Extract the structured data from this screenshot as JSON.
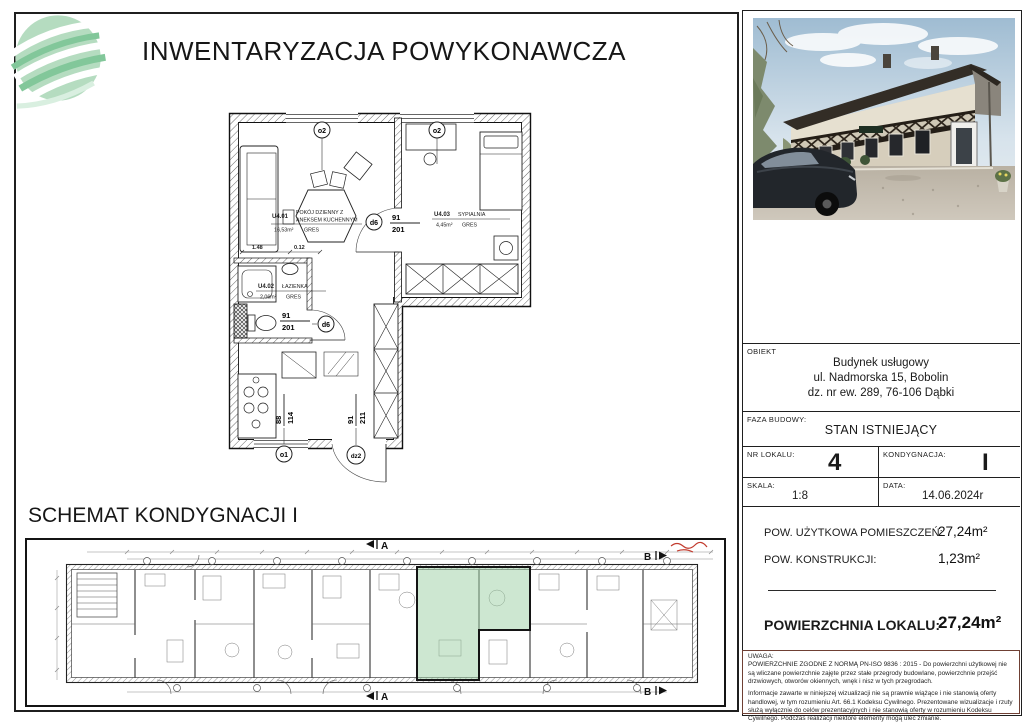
{
  "header": {
    "title": "INWENTARYZACJA POWYKONAWCZA"
  },
  "floor_plan": {
    "rooms": [
      {
        "id": "U4.01",
        "name_line1": "POKÓJ DZIENNY Z",
        "name_line2": "ANEKSEM KUCHENNYM",
        "area": "16,53m²",
        "floor": "GRES"
      },
      {
        "id": "U4.03",
        "name_line1": "SYPIALNIA",
        "name_line2": "",
        "area": "4,45m²",
        "floor": "GRES"
      },
      {
        "id": "U4.02",
        "name_line1": "ŁAZIENKA",
        "name_line2": "",
        "area": "2,06m²",
        "floor": "GRES"
      }
    ],
    "openings": [
      {
        "symbol": "o2",
        "dim_top": "",
        "dim_bottom": ""
      },
      {
        "symbol": "o2",
        "dim_top": "",
        "dim_bottom": ""
      },
      {
        "symbol": "d6",
        "dim_top": "91",
        "dim_bottom": "201"
      },
      {
        "symbol": "d6",
        "dim_top": "91",
        "dim_bottom": "201"
      },
      {
        "symbol": "o1",
        "dim_top": "88",
        "dim_bottom": "114"
      },
      {
        "symbol": "dz2",
        "dim_top": "91",
        "dim_bottom": "211"
      }
    ],
    "dims": {
      "d1": "1.48",
      "d2": "0.12"
    }
  },
  "schematic": {
    "heading": "SCHEMAT KONDYGNACJI I",
    "section_a": "A",
    "section_b": "B"
  },
  "info_table": {
    "obiekt_label": "OBIEKT",
    "obiekt_line1": "Budynek usługowy",
    "obiekt_line2": "ul. Nadmorska 15, Bobolin",
    "obiekt_line3": "dz. nr ew. 289, 76-106 Dąbki",
    "faza_label": "FAZA BUDOWY:",
    "faza_value": "STAN ISTNIEJĄCY",
    "nr_label": "NR LOKALU:",
    "nr_value": "4",
    "kond_label": "KONDYGNACJA:",
    "kond_value": "I",
    "skala_label": "SKALA:",
    "skala_value": "1:8",
    "data_label": "DATA:",
    "data_value": "14.06.2024r",
    "pow1_label": "POW. UŻYTKOWA POMIESZCZEŃ:",
    "pow1_value": "27,24m²",
    "pow2_label": "POW. KONSTRUKCJI:",
    "pow2_value": "1,23m²",
    "total_label": "POWIERZCHNIA LOKALU:",
    "total_value": "27,24m²"
  },
  "uwaga": {
    "label": "UWAGA:",
    "p1": "POWIERZCHNIE ZGODNE Z NORMĄ PN-ISO 9836 : 2015 - Do powierzchni użytkowej nie są wliczane powierzchnie zajęte przez stałe przegrody budowlane, powierzchnie przejść drzwiowych, otworów okiennych, wnęk i nisz w tych przegrodach.",
    "p2": "Informacje zawarte w niniejszej wizualizacji nie są prawnie wiążące i nie stanowią oferty handlowej, w tym rozumieniu Art. 66.1 Kodeksu Cywilnego. Prezentowane wizualizacje i rzuty służą wyłącznie do celów prezentacyjnych i nie stanowią oferty w rozumieniu Kodeksu Cywilnego. Podczas realizacji niektóre elementy mogą ulec zmianie."
  },
  "colors": {
    "highlight_green": "#9ccfa4",
    "annotation_red": "#c23b2e",
    "logo_green": "#b5dcc0",
    "logo_green_dark": "#82c79a"
  }
}
